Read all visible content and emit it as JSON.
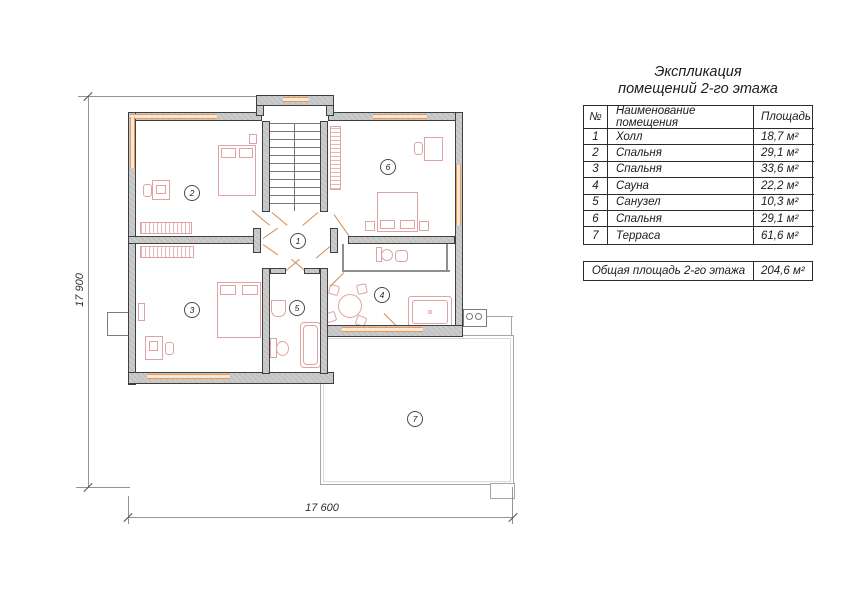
{
  "title": {
    "line1": "Экспликация",
    "line2": "помещений 2-го этажа"
  },
  "table": {
    "columns": [
      "№",
      "Наименование помещения",
      "Площадь"
    ],
    "rows": [
      {
        "num": "1",
        "name": "Холл",
        "area": "18,7 м²"
      },
      {
        "num": "2",
        "name": "Спальня",
        "area": "29,1 м²"
      },
      {
        "num": "3",
        "name": "Спальня",
        "area": "33,6 м²"
      },
      {
        "num": "4",
        "name": "Сауна",
        "area": "22,2 м²"
      },
      {
        "num": "5",
        "name": "Санузел",
        "area": "10,3 м²"
      },
      {
        "num": "6",
        "name": "Спальня",
        "area": "29,1 м²"
      },
      {
        "num": "7",
        "name": "Терраса",
        "area": "61,6 м²"
      }
    ],
    "total_label": "Общая площадь 2-го этажа",
    "total_value": "204,6 м²"
  },
  "plan": {
    "rooms": [
      {
        "num": "1"
      },
      {
        "num": "2"
      },
      {
        "num": "3"
      },
      {
        "num": "4"
      },
      {
        "num": "5"
      },
      {
        "num": "6"
      },
      {
        "num": "7"
      }
    ],
    "dims": {
      "left": "17 900",
      "bottom": "17 600"
    },
    "colors": {
      "wall_fill": "#cbcbcb",
      "wall_edge": "#3f3f3f",
      "window": "#e59a5c",
      "furniture": "#dfa3a3",
      "dimension": "#949494",
      "terrace_edge": "#a6a6a6"
    }
  }
}
